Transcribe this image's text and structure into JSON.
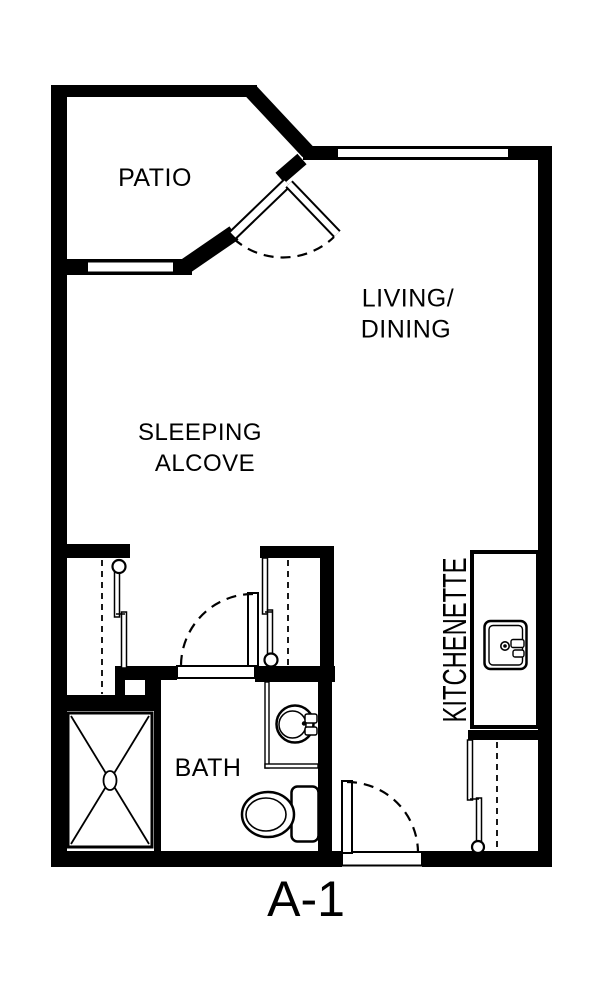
{
  "unit": {
    "label": "A-1"
  },
  "rooms": {
    "patio": {
      "label": "PATIO"
    },
    "living_dining": {
      "label_line1": "LIVING/",
      "label_line2": "DINING"
    },
    "sleeping_alcove": {
      "label_line1": "SLEEPING",
      "label_line2": "ALCOVE"
    },
    "bath": {
      "label": "BATH"
    },
    "kitchenette": {
      "label": "KITCHENETTE"
    }
  },
  "fixtures": [
    "shower-pan-with-x",
    "bathroom-vanity-sink",
    "toilet",
    "kitchenette-counter",
    "kitchen-sink",
    "left-closet-bypass-doors",
    "right-closet-bypass-doors",
    "entry-closet-bypass-doors",
    "patio-swing-door",
    "bath-swing-door",
    "entry-swing-door",
    "patio-window",
    "living-window"
  ],
  "colors": {
    "walls": "#000000",
    "background": "#ffffff",
    "floor": "#ffffff"
  }
}
